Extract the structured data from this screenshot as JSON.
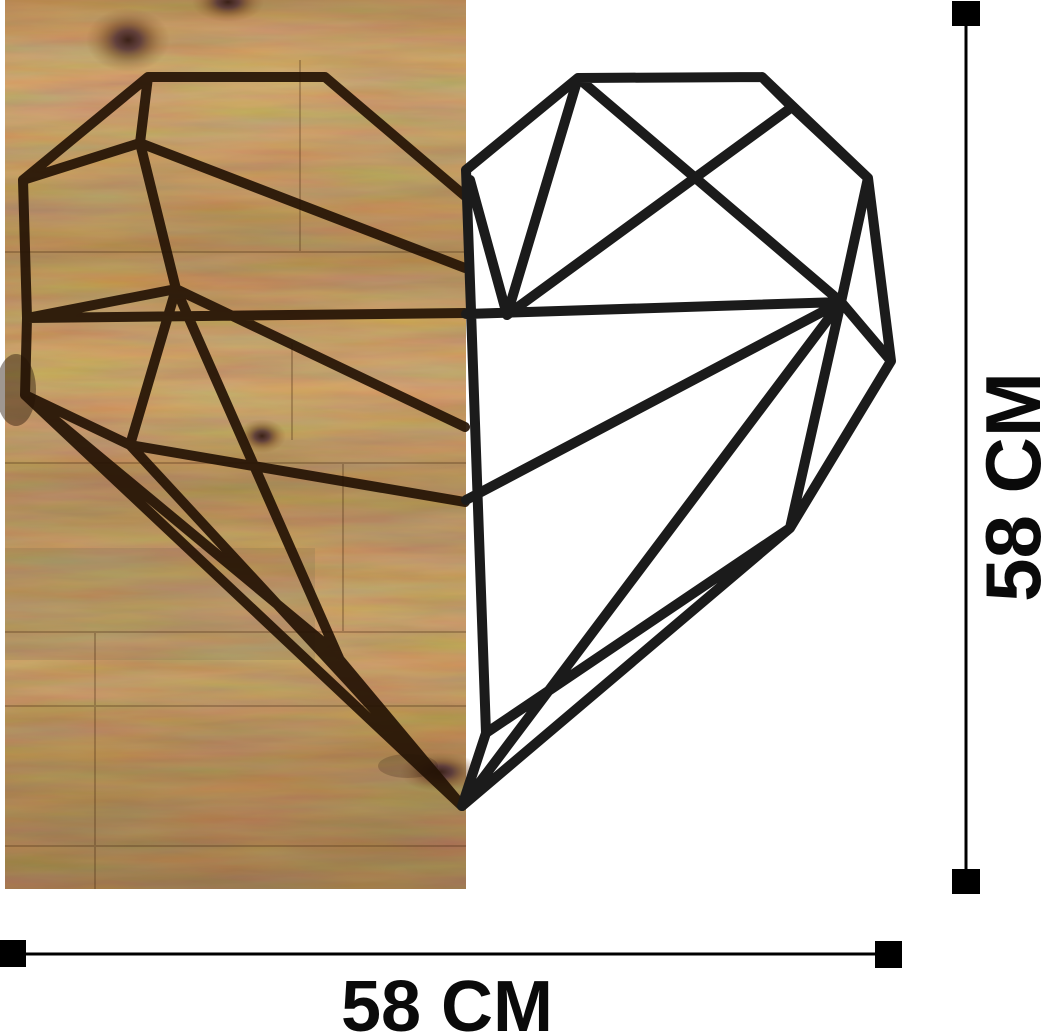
{
  "artwork": {
    "name": "Polygonal heart wall decor - left half engraved on wooden panel, right half black metal wireframe"
  },
  "dimensions": {
    "height_label": "58 CM",
    "width_label": "58 CM"
  },
  "colors": {
    "background": "#ffffff",
    "wood_base": "#a8733e",
    "wood_dark": "#6e4a23",
    "wood_light": "#c9995c",
    "engraving": "#241204",
    "metal": "#1b1b1b",
    "dimension_marker": "#000000"
  }
}
